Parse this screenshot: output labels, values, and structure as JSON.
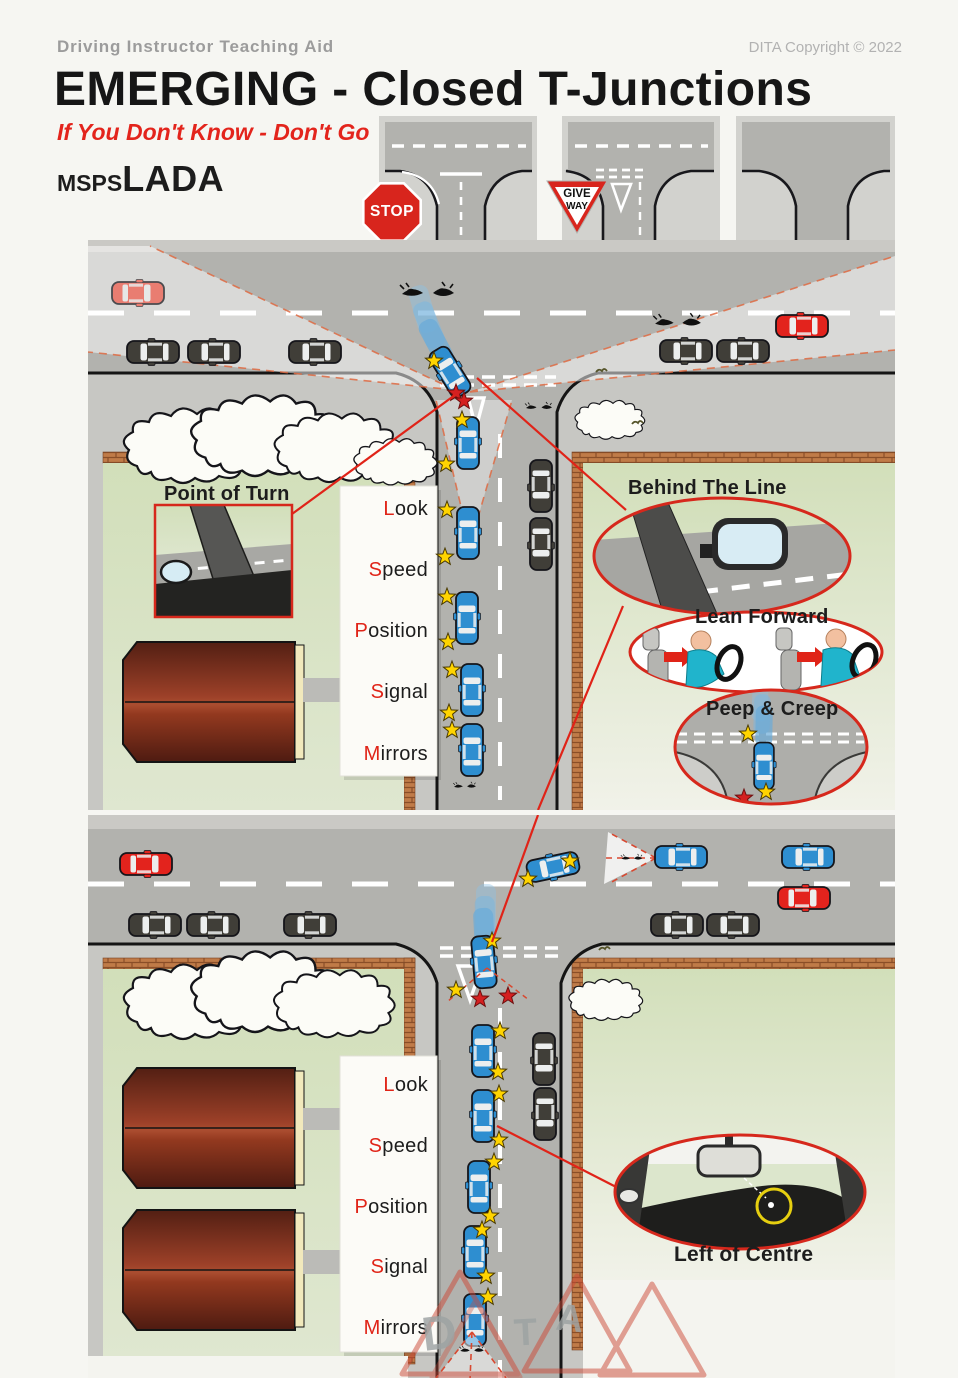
{
  "header": {
    "subtitle": "Driving Instructor Teaching Aid",
    "copyright": "DITA Copyright © 2022",
    "title": "EMERGING - Closed T-Junctions",
    "tagline": "If You Don't Know - Don't Go",
    "acronym_small": "MSPS",
    "acronym_large": "LADA"
  },
  "signs": {
    "stop": "STOP",
    "give_way_top": "GIVE",
    "give_way_bottom": "WAY"
  },
  "mspsl": {
    "items": [
      {
        "initial": "L",
        "rest": "ook"
      },
      {
        "initial": "S",
        "rest": "peed"
      },
      {
        "initial": "P",
        "rest": "osition"
      },
      {
        "initial": "S",
        "rest": "ignal"
      },
      {
        "initial": "M",
        "rest": "irrors"
      }
    ]
  },
  "callouts": {
    "point_of_turn": "Point of Turn",
    "behind_the_line": "Behind The Line",
    "lean_forward": "Lean Forward",
    "peep_and_creep": "Peep & Creep",
    "left_of_centre": "Left of Centre"
  },
  "watermark": {
    "letters": [
      "D",
      "T",
      "A"
    ]
  },
  "colors": {
    "accent_red": "#e02418",
    "car_blue": "#2e8ed0",
    "car_red": "#e3231d",
    "star_yellow": "#ffd400",
    "grass_green": "#d6e2c2",
    "road_grey": "#b2b2ae",
    "brick": "#c07b48",
    "building_maroon": "#8a3424"
  }
}
